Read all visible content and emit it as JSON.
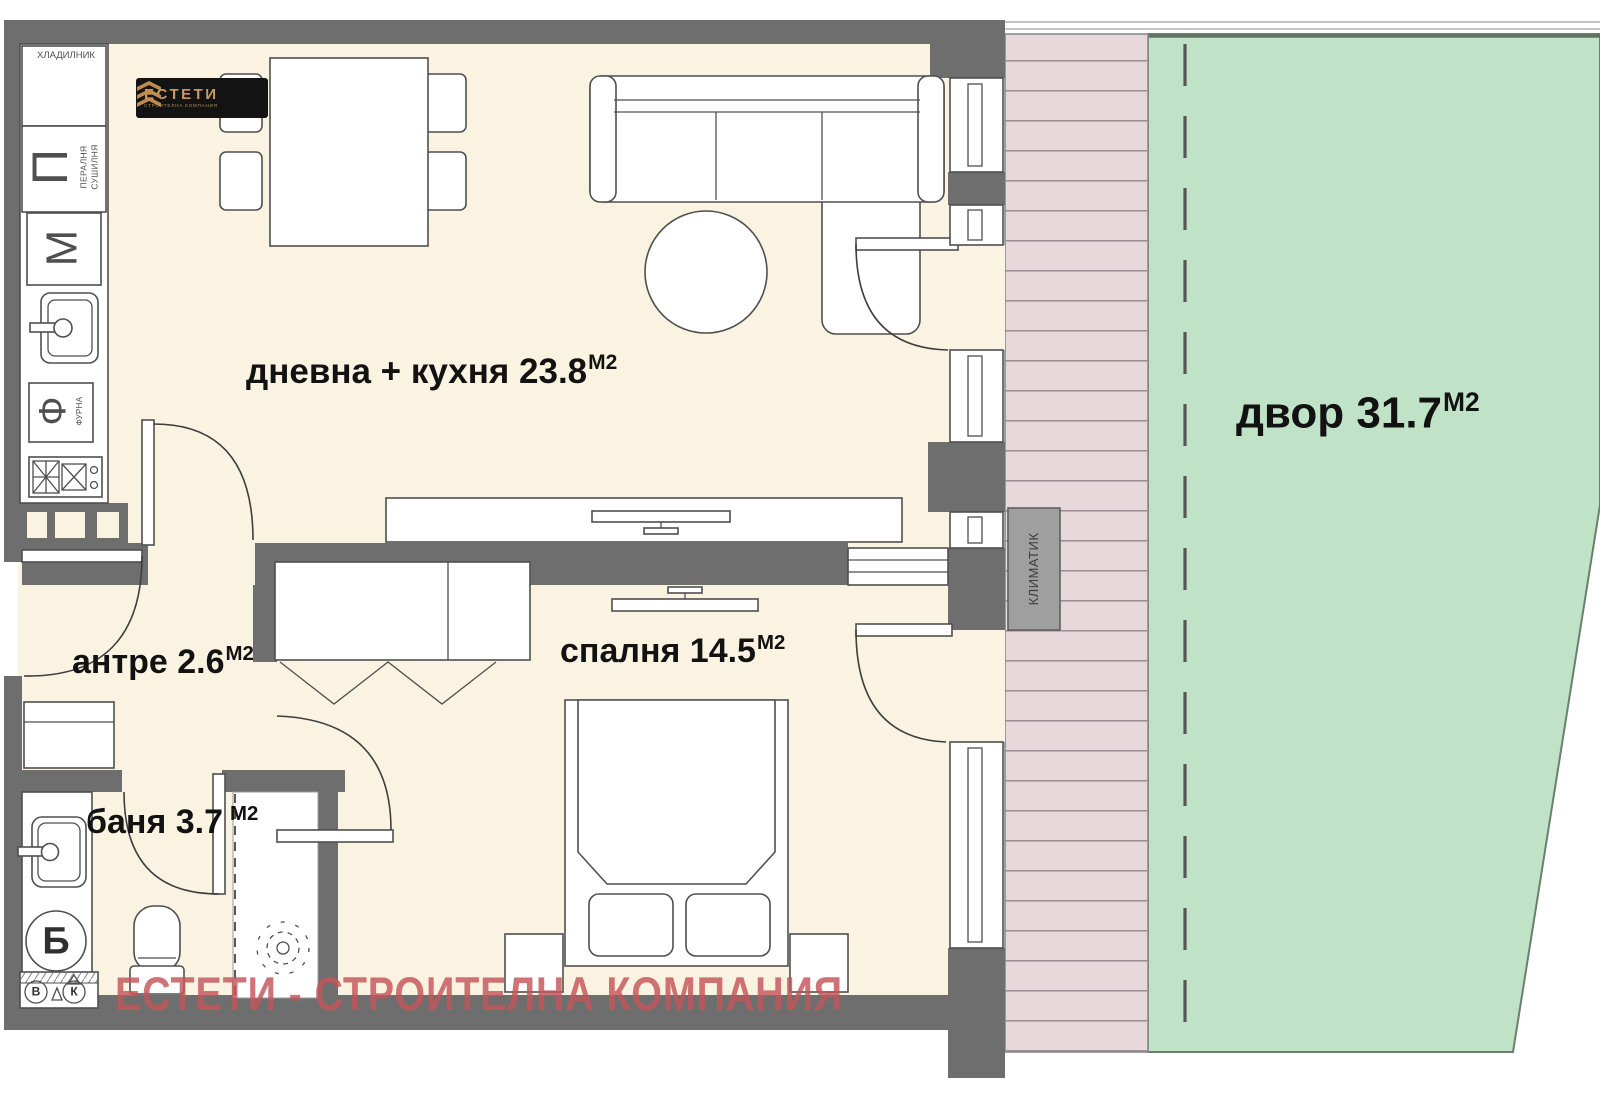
{
  "colors": {
    "wall": "#6e6e6e",
    "floor": "#faf3e2",
    "yard_green": "#c0e2c6",
    "deck_pink": "#e7d8db",
    "deck_line": "#9a8c91",
    "outline": "#4f4f4f",
    "watermark": "#c4555a",
    "logo_bg": "#131313",
    "logo_gold": "#c99b62",
    "ac_gray": "#9f9f9f"
  },
  "logo": {
    "title": "ЕСТЕТИ",
    "subtitle": "СТРОИТЕЛНА КОМПАНИЯ"
  },
  "watermark": "ЕСТЕТИ - СТРОИТЕЛНА КОМПАНИЯ",
  "rooms": {
    "living": {
      "name": "дневна + кухня",
      "area": "23.8",
      "unit": "М2"
    },
    "bedroom": {
      "name": "спалня",
      "area": "14.5",
      "unit": "М2"
    },
    "hall": {
      "name": "антре",
      "area": "2.6",
      "unit": "М2"
    },
    "bath": {
      "name": "баня",
      "area": "3.7",
      "unit": "М2"
    },
    "yard": {
      "name": "двор",
      "area": "31.7",
      "unit": "М2"
    }
  },
  "fixtures": {
    "fridge": "ХЛАДИЛНИК",
    "washer_letter": "П",
    "washer_sub": "ПЕРАЛНЯ\nСУШИЛНЯ",
    "dishwasher_letter": "М",
    "oven_letter": "Ф",
    "oven_sub": "ФУРНА",
    "boiler_letter": "Б",
    "valve_hot": "В",
    "valve_cold": "К",
    "ac": "КЛИМАТИК"
  }
}
